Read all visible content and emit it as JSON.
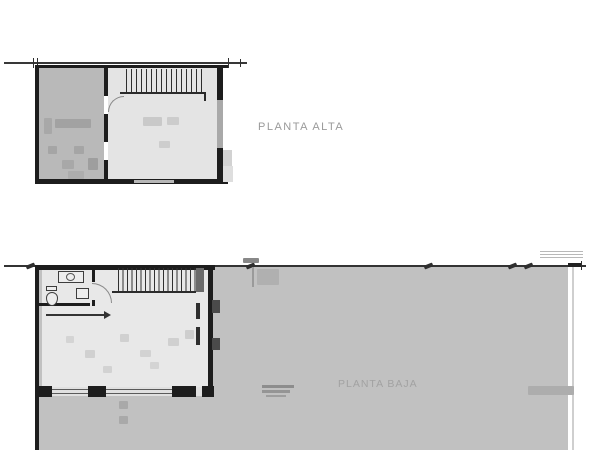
{
  "plans": {
    "upper": {
      "title": "PLANTA ALTA",
      "stair_treads": 16
    },
    "lower": {
      "title": "PLANTA BAJA",
      "stair_treads": 17
    }
  },
  "colors": {
    "wall": "#1d1d1d",
    "dim": "#383838",
    "terrain": "#c1c1c1",
    "room_shaded": "#b9b9b9",
    "room_light": "#e4e4e4",
    "interior": "#e8e8e8",
    "window": "#a9a9a9",
    "label": "#9a9a9a",
    "bg": "#ffffff"
  }
}
